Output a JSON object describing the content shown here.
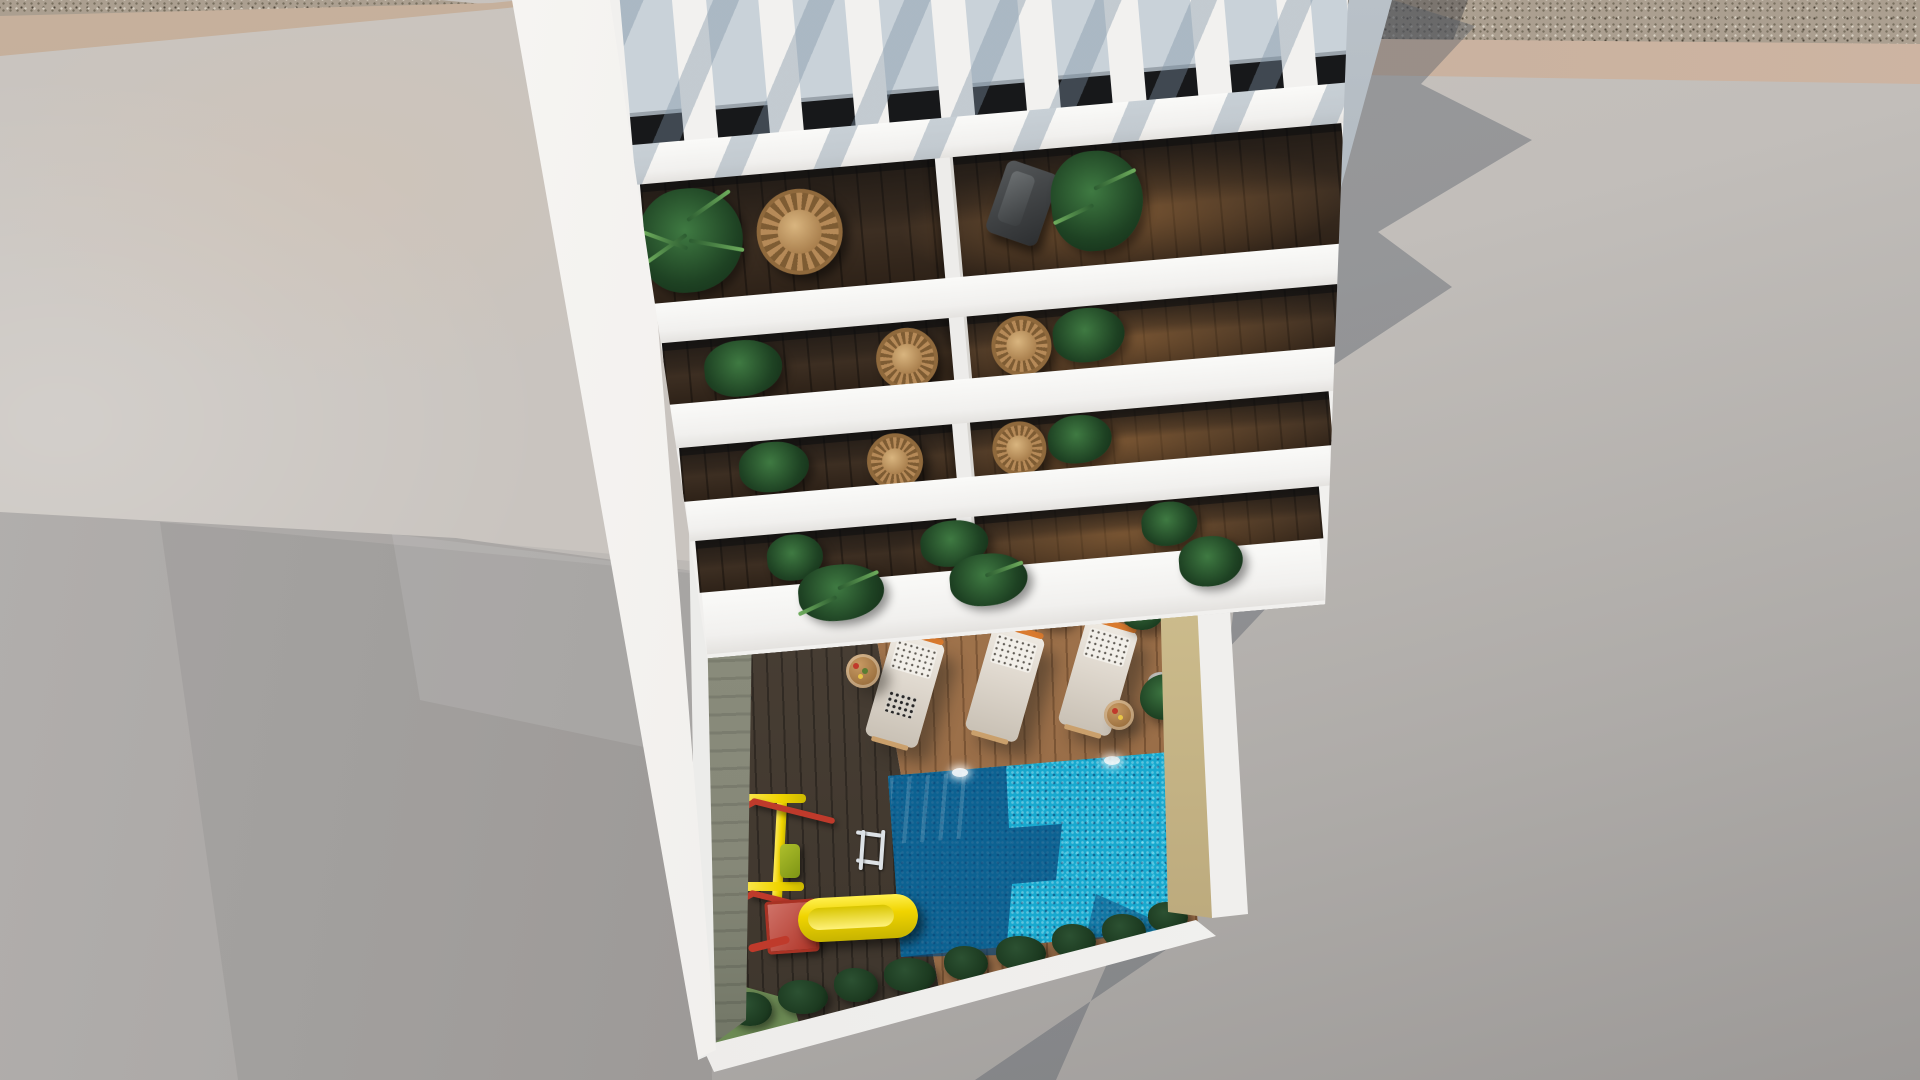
{
  "scene": {
    "type": "architectural-aerial-render",
    "description": "Top-down 3D visualization of a white apartment building with a slatted rooftop pergola, four tiers of balconies with plants and rattan chairs, and a ground-floor courtyard featuring a wooden sun deck, swimming pool, sun loungers and a children's playground, surrounded by concrete pavement with long cast shadows.",
    "building": {
      "pergola_slat_count": 9,
      "balcony_floors_visible": 4,
      "units_per_floor": 2,
      "balcony_furniture": [
        "rattan-egg-chairs",
        "gray-deck-chair",
        "potted-palms"
      ]
    },
    "courtyard": {
      "sunbed_count": 3,
      "side_table_count": 2,
      "potted_plant_count": 5,
      "hedge_bush_count": 9,
      "pool": {
        "underwater_light_count": 2,
        "has_ladder": true,
        "has_steps": true
      },
      "playground": {
        "swing_set_count": 1,
        "slide_count": 1,
        "spring_seat_count": 1
      }
    },
    "lighting": {
      "sun_direction": "upper-left",
      "shadow_direction": "lower-right"
    }
  },
  "colors": {
    "white": "#f1f0ee",
    "white2": "#fafaf8",
    "gap": "#c9d2d9",
    "glass": "#17181a",
    "wood": "#3b2d21",
    "deck_sun": "#a1744c",
    "deck_sh": "#483e34",
    "pool": "#18a9cf",
    "pool_sh": "#0b5d94",
    "pav_light": "#c9c4bf",
    "pav_dark": "#a3a09e",
    "tan": "#c6b09c",
    "sand": "#cfbf8f",
    "hedge": "#1c3a20",
    "plant": "#2f5c33",
    "yellow": "#f0d400",
    "red": "#bf3a2b",
    "wicker": "#b68a58",
    "bed": "#ded7cd",
    "orange": "#d97a2e",
    "grass": "#6c8a54",
    "moss": "#868878",
    "gravel": "#ab9f90"
  }
}
